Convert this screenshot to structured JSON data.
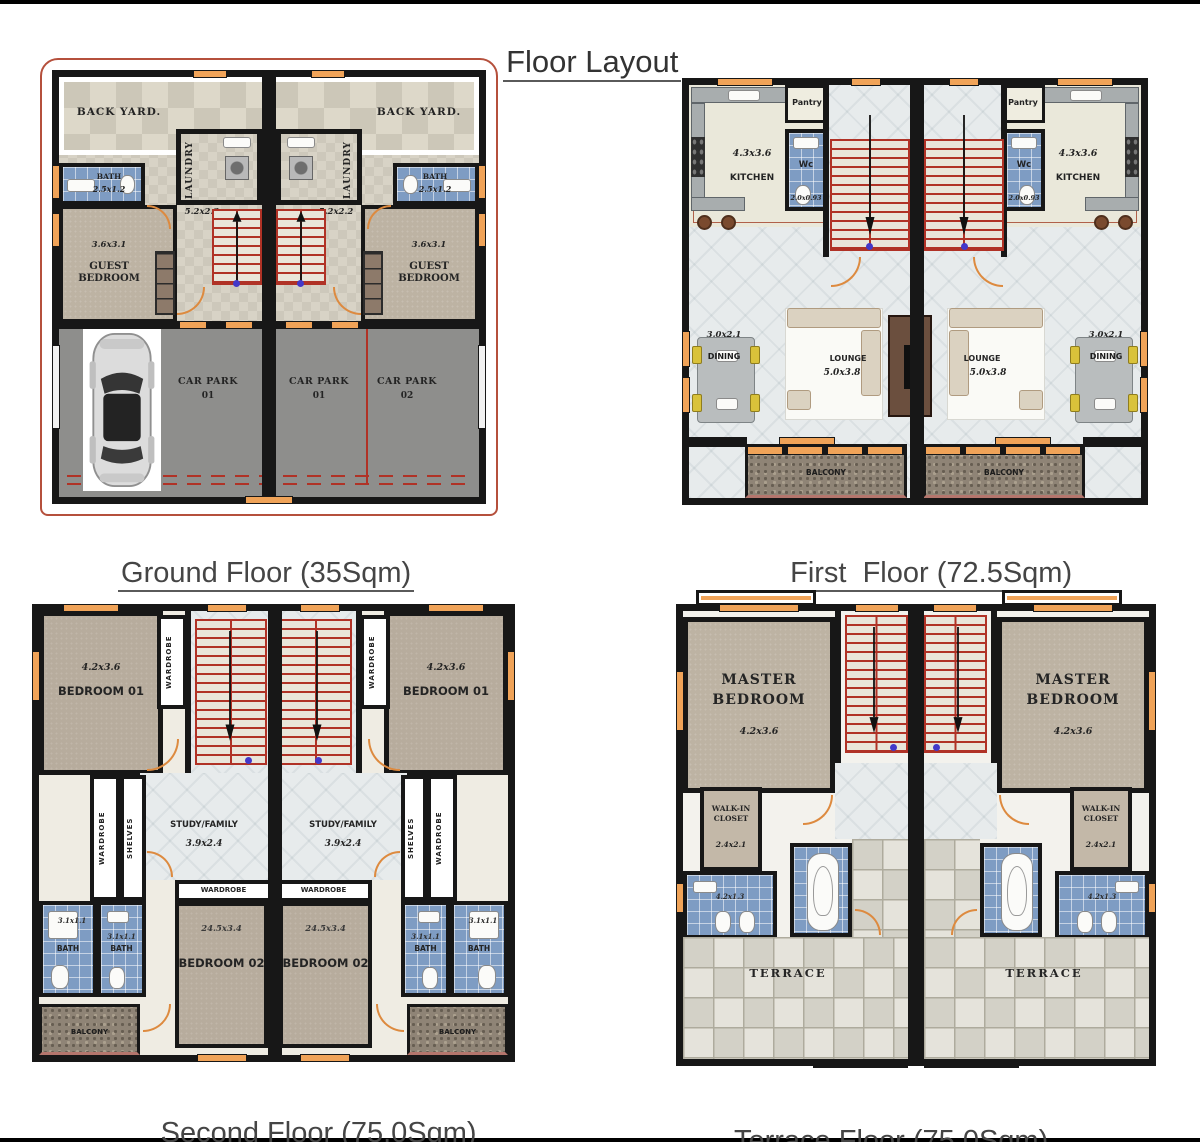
{
  "title": "Floor Layout",
  "colors": {
    "wall": "#171717",
    "stair_red": "#b03226",
    "door_orange": "#dd8a3f",
    "window_orange": "#f0a358",
    "bath_tile_blue": "#7e9cc3",
    "bedroom_tan": "#bdb3a3",
    "carpark_gray": "#8e8e8c",
    "backyard_beige": "#d9d4c5",
    "kitchen_cream": "#eae8da",
    "lounge_floor": "#e7ebec",
    "balcony_brown": "#8f8476",
    "terrace_tile": "#dcdacf",
    "outline_red": "#b5503c"
  },
  "ground": {
    "caption": "Ground Floor (35Sqm)",
    "back_yard": "BACK YARD.",
    "laundry": "LAUNDRY",
    "laundry_dim": "5.2x2.2",
    "bath": "BATH",
    "bath_dim": "2.5x1.2",
    "guest_dim": "3.6x3.1",
    "guest_l1": "GUEST",
    "guest_l2": "BEDROOM",
    "car_parks": [
      {
        "name": "CAR PARK",
        "num": "01"
      },
      {
        "name": "CAR PARK",
        "num": "01"
      },
      {
        "name": "CAR PARK",
        "num": "02"
      }
    ]
  },
  "first": {
    "caption": "First  Floor (72.5Sqm)",
    "pantry": "Pantry",
    "kitchen_dim": "4.3x3.6",
    "kitchen": "KITCHEN",
    "wc": "Wc",
    "wc_dim": "2.0x0.93",
    "dining_dim": "3.0x2.1",
    "dining": "DINING",
    "lounge": "LOUNGE",
    "lounge_dim": "5.0x3.8",
    "balcony": "BALCONY"
  },
  "second": {
    "caption": "Second Floor (75.0Sqm)",
    "bedroom1_dim": "4.2x3.6",
    "bedroom1": "BEDROOM 01",
    "wardrobe": "WARDROBE",
    "shelves": "SHELVES",
    "study": "STUDY/FAMILY",
    "study_dim": "3.9x2.4",
    "bath": "BATH",
    "bath_dim": "3.1x1.1",
    "wardrobe2": "WARDROBE",
    "bedroom2_dim": "24.5x3.4",
    "bedroom2": "BEDROOM 02",
    "balcony": "BALCONY"
  },
  "terrace": {
    "caption": "Terrace Floor (75.0Sqm)",
    "master_l1": "MASTER",
    "master_l2": "BEDROOM",
    "master_dim": "4.2x3.6",
    "wic_l1": "WALK-IN",
    "wic_l2": "CLOSET",
    "wic_dim": "2.4x2.1",
    "bath_dim": "4.2x1.3",
    "terrace": "TERRACE"
  }
}
